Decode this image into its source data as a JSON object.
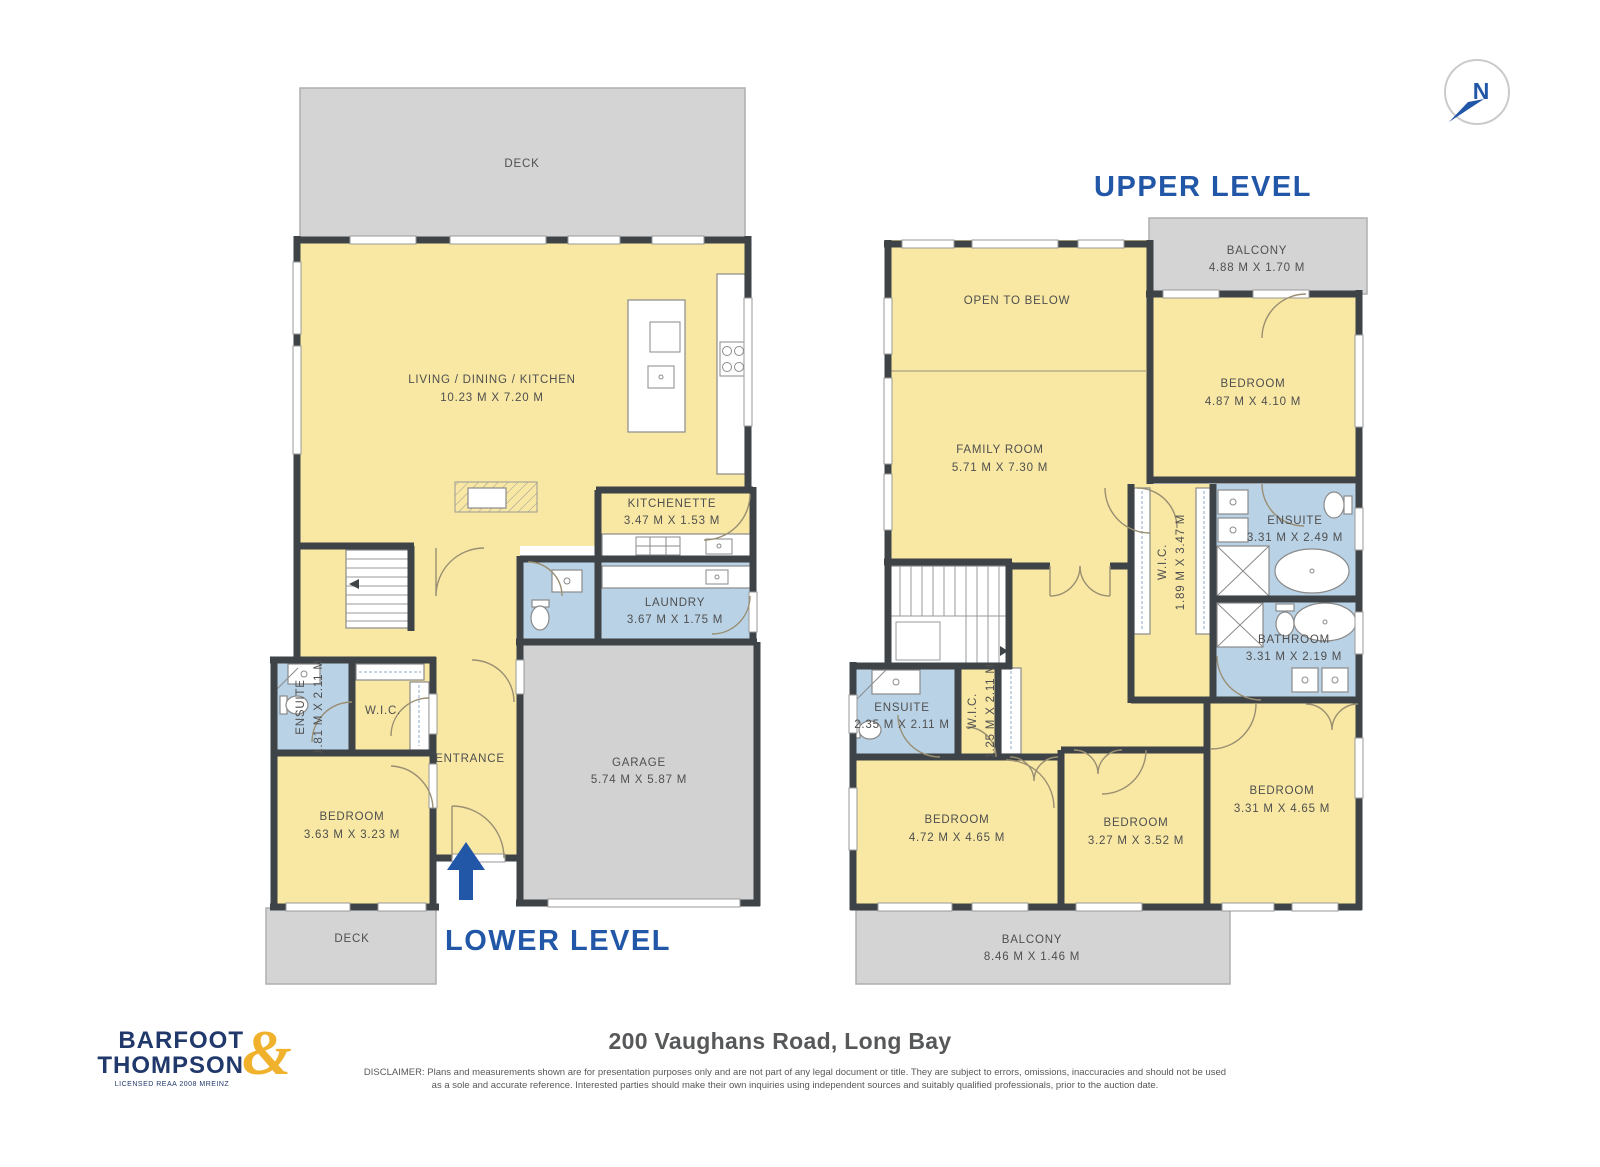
{
  "compass": {
    "label": "N"
  },
  "levels": {
    "upper": {
      "title": "UPPER LEVEL",
      "rooms": {
        "balcony_top": {
          "name": "BALCONY",
          "dims": "4.88 M X 1.70 M"
        },
        "open_to_below": {
          "name": "OPEN TO BELOW"
        },
        "family_room": {
          "name": "FAMILY ROOM",
          "dims": "5.71 M X 7.30 M"
        },
        "bedroom_tr": {
          "name": "BEDROOM",
          "dims": "4.87 M X 4.10 M"
        },
        "ensuite_main": {
          "name": "ENSUITE",
          "dims": "3.31 M X 2.49 M"
        },
        "wic_main": {
          "name": "W.I.C.",
          "dims": "1.89 M X 3.47 M"
        },
        "bathroom": {
          "name": "BATHROOM",
          "dims": "3.31 M X 2.19 M"
        },
        "ensuite_2": {
          "name": "ENSUITE",
          "dims": "2.35 M X 2.11 M"
        },
        "wic_2": {
          "name": "W.I.C.",
          "dims": "1.25 M X 2.11 M"
        },
        "bedroom_bl": {
          "name": "BEDROOM",
          "dims": "4.72 M X 4.65 M"
        },
        "bedroom_bm": {
          "name": "BEDROOM",
          "dims": "3.27 M X 3.52 M"
        },
        "bedroom_br": {
          "name": "BEDROOM",
          "dims": "3.31 M X 4.65 M"
        },
        "balcony_bottom": {
          "name": "BALCONY",
          "dims": "8.46 M X 1.46 M"
        }
      }
    },
    "lower": {
      "title": "LOWER LEVEL",
      "rooms": {
        "deck_top": {
          "name": "DECK"
        },
        "living": {
          "name": "LIVING / DINING / KITCHEN",
          "dims": "10.23 M X 7.20 M"
        },
        "kitchenette": {
          "name": "KITCHENETTE",
          "dims": "3.47 M X 1.53 M"
        },
        "laundry": {
          "name": "LAUNDRY",
          "dims": "3.67 M X 1.75 M"
        },
        "entrance": {
          "name": "ENTRANCE"
        },
        "garage": {
          "name": "GARAGE",
          "dims": "5.74 M X 5.87 M"
        },
        "ensuite": {
          "name": "ENSUITE",
          "dims": "1.81 M X 2.11 M"
        },
        "wic": {
          "name": "W.I.C."
        },
        "bedroom": {
          "name": "BEDROOM",
          "dims": "3.63 M X 3.23 M"
        },
        "deck_bottom": {
          "name": "DECK"
        }
      }
    }
  },
  "footer": {
    "brand": {
      "line1": "BARFOOT",
      "line2": "THOMPSON",
      "ampersand": "&",
      "tagline": "LICENSED REAA 2008 MREINZ"
    },
    "address": "200 Vaughans Road, Long Bay",
    "disclaimer_line1": "DISCLAIMER: Plans and measurements shown are for presentation purposes only and are not part of any legal document or title. They are subject to errors, omissions, inaccuracies and should not be used",
    "disclaimer_line2": "as a sole and accurate reference. Interested parties should make their own inquiries using independent sources and suitably qualified professionals, prior to the auction date."
  },
  "colors": {
    "room_fill": "#F8E8A3",
    "wet_room_fill": "#B9D2E6",
    "outdoor_fill": "#D4D4D4",
    "wall": "#3E4347",
    "accent_blue": "#2257A8",
    "brand_navy": "#21386B",
    "brand_gold": "#F0B22D"
  }
}
